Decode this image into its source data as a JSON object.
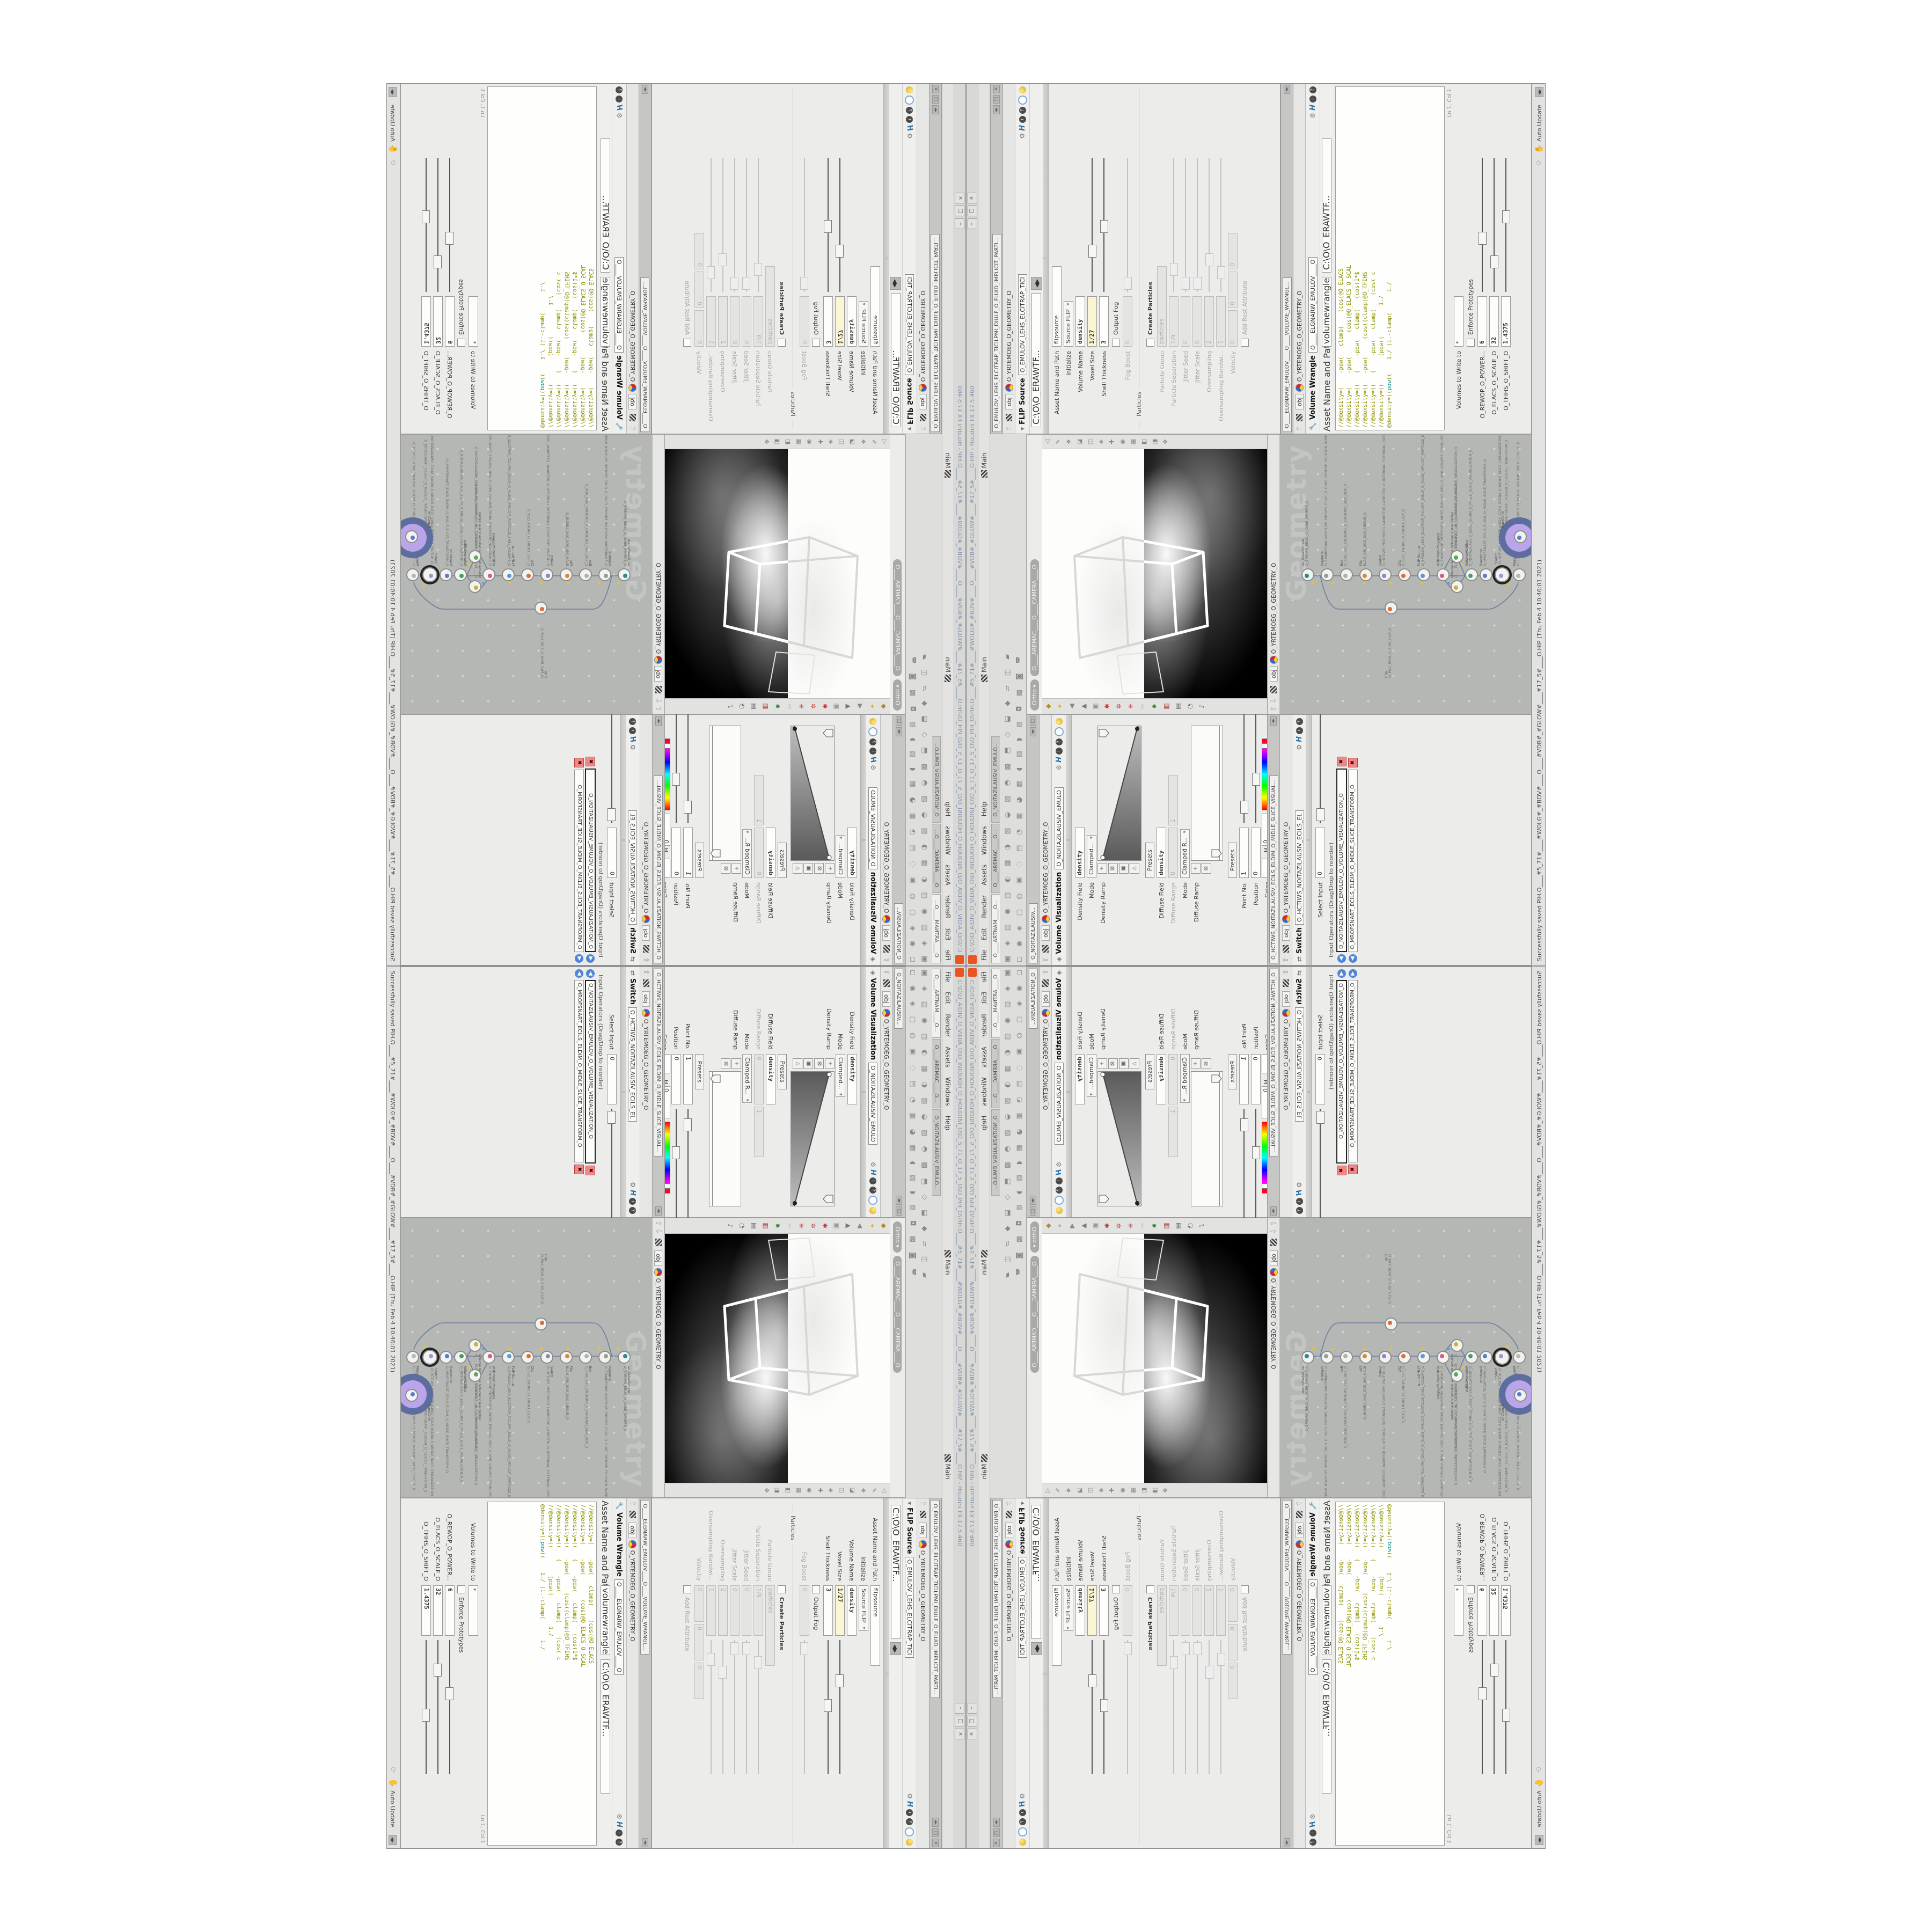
{
  "window": {
    "title": "C:\\O\\O_AIDIV_O_VIDIA_O\\O_INIDUOH_O_HOUDINI_O\\O_5_71_O_17_5_O\\O_PIH_O\\PIH.O____#5_71#____#WOLG#_#BDV#____O____#VDB#_#GLOW#____#17_5#____O.HIP - Houdini FX 17.5.460",
    "buttons": {
      "min": "–",
      "max": "□",
      "close": "×"
    }
  },
  "menu": {
    "items": [
      "File",
      "Edit",
      "Render",
      "Assets",
      "Windows",
      "Help"
    ],
    "desktop": "Main",
    "take": "Main"
  },
  "shelf": {
    "tabs": [
      "O____ARTNAM____O...",
      "O____AREMAC____O...",
      "O_NOITAZILAUSIV_EMULO..."
    ],
    "icons_row1": "▣ ◈ ▤ ◉ ▥ ◐ ▦ ◑ ▧ ◒ ▨ ◓ ▩ ⬒ ◇ ⬓ ◆ ▱ ◫ ▰",
    "icons_row2": "◻ ◉ ◈ ▢ ◍ ▣ ◌ ▤ ◔ ▥ ◕ ▦ ◖ ▧ ◗ ▨ ◘ ▩ ◙ ◚"
  },
  "paths": {
    "context": "obj",
    "geometry": "O_YRTEMOEG_O_GEOMETRY_O",
    "file": "C:\\O\\O_ERAWTF..."
  },
  "viewport": {
    "ortho": "Ortho ▾",
    "camera": "O____AREMAC____O____CAMERA____O",
    "left_icons": "◆ ✦ ◀ ▲ ▣ ✱ ✲ ✳ ✂ ✸ ▥ ▤ ◔ ♪",
    "right_icons": "◁ ✎ ❖ ◪ ◫ ◈ ✚ ◉ ▦ ◧ ◨ ✥"
  },
  "status": {
    "saved": "Successfully saved PIH.O____#5_71#____#WOLG#_#BDV#____O____#VDB#_#GLOW#____#17_5#____O.HIP (Thu Feb  4 10:46:01 2021)",
    "update_mode": "Auto Update"
  },
  "viz_pane": {
    "tab": "O_NOITAZILAUSIV...",
    "title": "Volume Visualization",
    "node_name": "O_NOITAZILAUSIV_EMULO",
    "rows": [
      {
        "label": "Density Field",
        "value": "density"
      },
      {
        "label": "Mode",
        "value": "Clamped..."
      },
      {
        "label": "Density Ramp"
      },
      {
        "label": "",
        "value": "Presets"
      },
      {
        "label": "Diffuse Field",
        "value": "density"
      },
      {
        "label": "Diffuse Range",
        "value": "0",
        "value2": "1"
      },
      {
        "label": "Mode",
        "value": "Clamped R..."
      },
      {
        "label": "Diffuse Ramp"
      },
      {
        "label": "",
        "value": "Presets"
      },
      {
        "label": "Point No.",
        "value": "1"
      },
      {
        "label": "Position",
        "value": "0"
      },
      {
        "label": "Color",
        "h": "0",
        "s": "0",
        "v": "1.8125"
      },
      {
        "label": "Interpolation",
        "value": "Linear"
      }
    ]
  },
  "switch_pane": {
    "tab": "O_HCTIWS_NOITAZILAUSIV_ECILS_ELDIM_O_MIDLE_SLICE_VISUAL...",
    "title": "Switch",
    "node_name": "O_HCTIWS_NOITAZILAUSIV_ECILS_EL",
    "select_input_label": "Select Input",
    "select_input_value": "0",
    "ops_label": "Input Operators (Drag/Drop to reorder)",
    "items": [
      "O_NOITAZILAUSIV_EMULOV_O_VOLUME_VISUALIZATION_O",
      "O_MROFSNART_ECILS_ELDIM_O_MIDLE_SLICE_TRANSFORM_O"
    ]
  },
  "flip_pane": {
    "tab": "O_EMULOV_LEHS_ELCITRAP_TICILPMI_DIULF_O_FLUID_IMPLICIT_PARTI...",
    "title": "FLIP Source",
    "node_name": "O_EMULOV_LEHS_ELCITRAP_TICI",
    "rows": [
      {
        "label": "Asset Name and Path",
        "value": "flipsource"
      },
      {
        "label": "Initialize",
        "value": "Source FLIP"
      },
      {
        "label": "Volume Name",
        "value": "density"
      },
      {
        "label": "Voxel Size",
        "value": "1/27"
      },
      {
        "label": "Shell Thickness",
        "value": "3"
      },
      {
        "label": "Output Fog"
      },
      {
        "label": "Fog Boost",
        "value": "0"
      },
      {
        "label": "Particles"
      },
      {
        "label": "Create Particles"
      },
      {
        "label": "Particle Group",
        "value": "particles"
      },
      {
        "label": "Particle Separation",
        "value": "1/9"
      },
      {
        "label": "Jitter Seed",
        "value": "0"
      },
      {
        "label": "Jitter Scale",
        "value": "0"
      },
      {
        "label": "Oversampling",
        "value": "2"
      },
      {
        "label": "Oversampling Bandwi...",
        "value": "1"
      },
      {
        "label": "Velocity",
        "value": "0",
        "value2": "0",
        "value3": "0"
      },
      {
        "label": "Add Rest Attribute"
      }
    ]
  },
  "wrangle_pane": {
    "tab": "O____ELGNARW_EMULOV____O____VOLUME_WRANGL...",
    "title": "Volume Wrangle",
    "node_name": "O____ELGNARW_EMULOV____O",
    "name_label": "Asset Name and Path",
    "name_value": "volumewrangle",
    "code": [
      "//@density=(    -pow(   clamp(    (cos(@O_ELACS_",
      "//@density=(    -pow(       (cos(@O_ELACS_O_SCAL",
      "//@density=((   (    -pow(   clamp(   (cos(1*$",
      "//@density=((   -pow(     (cos((clamp(@O_TFIHS",
      "//@density=((   (    -pow(   clamp(    (cos( c",
      "//@density=((        (pow((         1./"
    ],
    "code_active_a": "@density=((",
    "code_active_kw": "pow",
    "code_active_b": "((    1./ (1.-clamp(      1./",
    "ln": "Ln 1, Col 1",
    "volumes_label": "Volumes to Write to",
    "volumes_value": "*",
    "proto_label": "Enforce Prototypes",
    "sliders": [
      {
        "label": "O_REWOP_O_POWER...",
        "value": "6"
      },
      {
        "label": "O_ELACS_O_SCALE_O",
        "value": "32"
      },
      {
        "label": "O_TFIHS_O_SHIFT_O",
        "value": "1.4375"
      }
    ]
  },
  "network": {
    "watermark": "Geometry",
    "nodes": [
      {
        "t": "ao_CubeSphere",
        "n": "O_EREHPS_EBUC_O_CUBE_SPHERE_O"
      },
      {
        "t": "PolyWire",
        "n": "O_EMARFERIW_NOGYLOP_EREHPS_EBUC_O_CUBE_SPHERE_POLYGON_WIREFRAME_O"
      },
      {
        "t": "Box",
        "n": "O_XOB_BUS_DNUORG_O_GROUND_SUB_BOX_O"
      },
      {
        "t": "File",
        "n": "BLAH_OBJ_SOS_NAO_UBSUB_O"
      },
      {
        "t": "Switch",
        "n": "O_HCTIWS_YRTEMOEG_LANRETXE_LANRETNI_O_INTERNAL_EXTERNAL_GEOMETRY_SWITCH_O"
      },
      {
        "t": "Clip",
        "n": "O_PILC_TNORF_O_FRONT_CLIP_O"
      },
      {
        "t": "FLIP Source",
        "n": "O_EMULOV_LEHS_ELCITRAP_TICILPMI_DIULF_O_FLUID_IMPLICIT_PARTICLE_SHEL_VOLUME_O"
      },
      {
        "t": "VDB from Polygons",
        "n": "O_SNOGYLOP_YRTEMOEG_MORF_EMULOV_BDV_O_VDB_VOLUME_FROM_GEOMETRY_POLYGONS_O"
      },
      {
        "t": "Volume Wrangle",
        "n": "O____ELGNARW_EMULOV____O____VOLUME_WRANGLE____O"
      },
      {
        "t": "Volume Visualization",
        "n": "O_NOITAZILAUSIV_EMULOV_O_VOLUME_VISUALIZATION_O"
      },
      {
        "t": "VolumeVizSlice",
        "n": "O_NOITAZILAUSIV_ECILS_ELDIM_O_MIDLE_SLICE_VISUALIZATION_O"
      },
      {
        "t": "Transform",
        "n": "O_MROFSNART_ECILS_ELDIM_O_MIDLE_SLICE_TRANSFORM_O"
      },
      {
        "t": "Switch",
        "n": "O_HCTIWS_NOITAZILAUSIV_ECILS_ELDIM_O_MIDLE_SLICE_VISUALIZATION_SWITCH_O"
      },
      {
        "t": "Merge",
        "n": "O_EGREM_HTIW_EMULOV_EGREM_O_MERGE_VOLUME_WITH_SPHERE_O"
      },
      {
        "t": "Clip",
        "n": "O_PILC_EDIS_O_SIDE_CLIP_O"
      },
      {
        "t": "Transform",
        "n": "O_MROFSNART_TLUSER_O_RESULT_TRANSFORM_O"
      }
    ]
  }
}
